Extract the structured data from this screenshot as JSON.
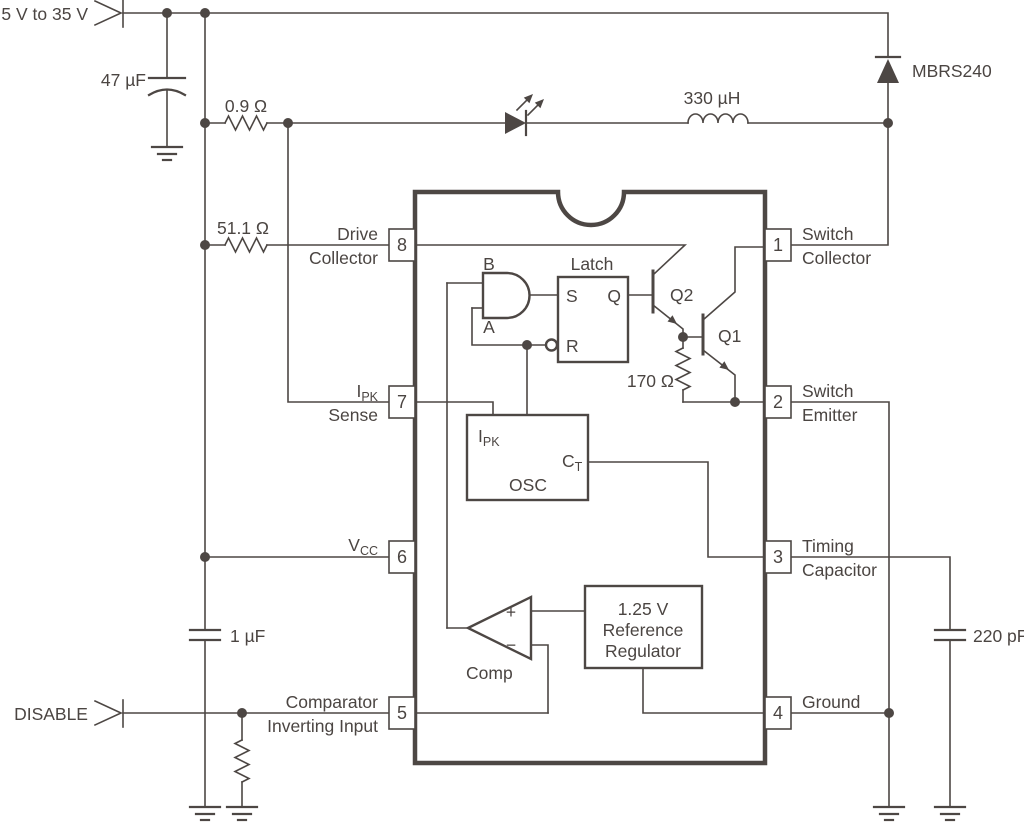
{
  "colors": {
    "ink": "#4d4744",
    "background": "#ffffff"
  },
  "inputs": {
    "power": "5 V to 35 V",
    "disable": "DISABLE"
  },
  "components": {
    "input_cap": "47 µF",
    "sense_resistor": "0.9 Ω",
    "drive_resistor": "51.1 Ω",
    "inductor": "330 µH",
    "diode": "MBRS240",
    "base_resistor": "170 Ω",
    "vcc_cap": "1 µF",
    "timing_cap": "220 pF"
  },
  "ic": {
    "and_gate": {
      "input_b": "B",
      "input_a": "A"
    },
    "latch": {
      "title": "Latch",
      "s": "S",
      "q": "Q",
      "r": "R"
    },
    "osc": {
      "title": "OSC",
      "ipk_main": "I",
      "ipk_sub": "PK",
      "ct_main": "C",
      "ct_sub": "T"
    },
    "comparator": {
      "label": "Comp",
      "plus": "+",
      "minus": "−"
    },
    "reference": {
      "line1": "1.25 V",
      "line2": "Reference",
      "line3": "Regulator"
    },
    "q1": "Q1",
    "q2": "Q2",
    "pins": {
      "p1": {
        "n": "1",
        "l1": "Switch",
        "l2": "Collector"
      },
      "p2": {
        "n": "2",
        "l1": "Switch",
        "l2": "Emitter"
      },
      "p3": {
        "n": "3",
        "l1": "Timing",
        "l2": "Capacitor"
      },
      "p4": {
        "n": "4",
        "l1": "Ground"
      },
      "p5": {
        "n": "5",
        "l1": "Comparator",
        "l2": "Inverting Input"
      },
      "p6": {
        "n": "6",
        "main": "V",
        "sub": "CC"
      },
      "p7": {
        "n": "7",
        "main": "I",
        "sub": "PK",
        "l2": "Sense"
      },
      "p8": {
        "n": "8",
        "l1": "Drive",
        "l2": "Collector"
      }
    }
  }
}
